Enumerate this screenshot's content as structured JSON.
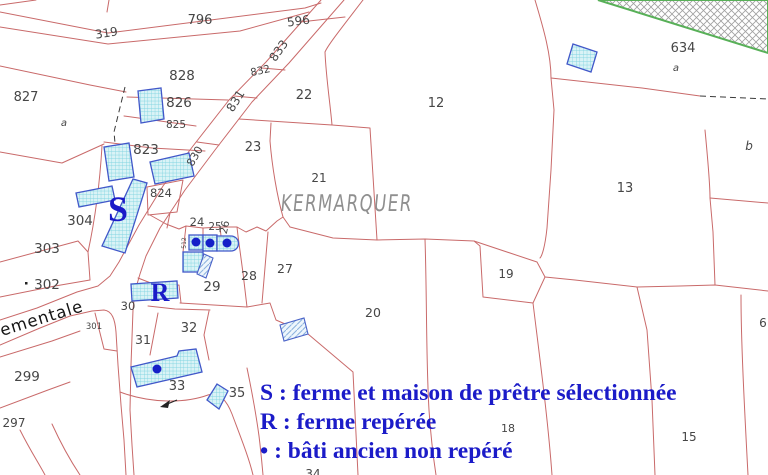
{
  "map": {
    "place_name": "KERMARQUER",
    "road_name_fragment": "ementale",
    "marker_s": {
      "text": "S",
      "x": 118,
      "y": 221,
      "size": 36
    },
    "marker_r": {
      "text": "R",
      "x": 160,
      "y": 301,
      "size": 26
    },
    "colors": {
      "parcel_line": "#c96a6a",
      "building_border": "#4157c9",
      "building_fill": "#daf3f6",
      "building_hatch": "#7ed3e0",
      "dot_blue": "#1520c8",
      "legend_blue": "#1b1bc8",
      "label_gray": "#464646",
      "place_gray": "#8f8f8f",
      "green_border": "#58b058"
    },
    "parcel_labels": [
      {
        "text": "796",
        "x": 200,
        "y": 24,
        "size": 13
      },
      {
        "text": "319",
        "x": 107,
        "y": 37,
        "size": 12,
        "rot": -9
      },
      {
        "text": "596",
        "x": 299,
        "y": 25,
        "size": 12,
        "rot": -8
      },
      {
        "text": "833",
        "x": 282,
        "y": 53,
        "size": 12,
        "rot": -55
      },
      {
        "text": "832",
        "x": 261,
        "y": 74,
        "size": 10.5,
        "rot": -12
      },
      {
        "text": "831",
        "x": 239,
        "y": 103,
        "size": 12,
        "rot": -58
      },
      {
        "text": "830",
        "x": 198,
        "y": 158,
        "size": 11,
        "rot": -60
      },
      {
        "text": "827",
        "x": 26,
        "y": 101,
        "size": 13
      },
      {
        "text": "828",
        "x": 182,
        "y": 80,
        "size": 13.5
      },
      {
        "text": "826",
        "x": 179,
        "y": 107,
        "size": 13.5
      },
      {
        "text": "825",
        "x": 176,
        "y": 128,
        "size": 10.5
      },
      {
        "text": "823",
        "x": 146,
        "y": 154,
        "size": 13.5
      },
      {
        "text": "824",
        "x": 161,
        "y": 197,
        "size": 11.5
      },
      {
        "text": "a",
        "x": 64,
        "y": 126,
        "size": 10,
        "italic": true
      },
      {
        "text": "22",
        "x": 304,
        "y": 99,
        "size": 13
      },
      {
        "text": "23",
        "x": 253,
        "y": 151,
        "size": 13
      },
      {
        "text": "21",
        "x": 319,
        "y": 182,
        "size": 12
      },
      {
        "text": "12",
        "x": 436,
        "y": 107,
        "size": 13
      },
      {
        "text": "13",
        "x": 625,
        "y": 192,
        "size": 13
      },
      {
        "text": "634",
        "x": 683,
        "y": 52,
        "size": 13
      },
      {
        "text": "a",
        "x": 676,
        "y": 71,
        "size": 10,
        "italic": true
      },
      {
        "text": "b",
        "x": 749,
        "y": 150,
        "size": 12,
        "italic": true
      },
      {
        "text": "304",
        "x": 80,
        "y": 225,
        "size": 13.5
      },
      {
        "text": "303",
        "x": 47,
        "y": 253,
        "size": 13.5
      },
      {
        "text": "302",
        "x": 47,
        "y": 289,
        "size": 13.5
      },
      {
        "text": "301",
        "x": 94,
        "y": 329,
        "size": 8.5
      },
      {
        "text": "299",
        "x": 27,
        "y": 381,
        "size": 13.5
      },
      {
        "text": "297",
        "x": 14,
        "y": 427,
        "size": 12
      },
      {
        "text": "30",
        "x": 128,
        "y": 310,
        "size": 11.5
      },
      {
        "text": "31",
        "x": 143,
        "y": 344,
        "size": 12.5
      },
      {
        "text": "32",
        "x": 189,
        "y": 332,
        "size": 13
      },
      {
        "text": "33",
        "x": 177,
        "y": 390,
        "size": 13
      },
      {
        "text": "35",
        "x": 237,
        "y": 397,
        "size": 13
      },
      {
        "text": "34",
        "x": 313,
        "y": 478,
        "size": 12
      },
      {
        "text": "29",
        "x": 212,
        "y": 291,
        "size": 13.5
      },
      {
        "text": "28",
        "x": 249,
        "y": 280,
        "size": 12.5
      },
      {
        "text": "27",
        "x": 285,
        "y": 273,
        "size": 12.5
      },
      {
        "text": "24",
        "x": 197,
        "y": 226,
        "size": 11.5
      },
      {
        "text": "25",
        "x": 215,
        "y": 230,
        "size": 10.5
      },
      {
        "text": "26",
        "x": 228,
        "y": 228,
        "size": 10.5,
        "rot": -78
      },
      {
        "text": "512",
        "x": 186,
        "y": 243,
        "size": 6,
        "rot": -90
      },
      {
        "text": "20",
        "x": 373,
        "y": 317,
        "size": 12.5
      },
      {
        "text": "19",
        "x": 506,
        "y": 278,
        "size": 12
      },
      {
        "text": "18",
        "x": 508,
        "y": 432,
        "size": 11
      },
      {
        "text": "15",
        "x": 689,
        "y": 441,
        "size": 12
      },
      {
        "text": "6",
        "x": 763,
        "y": 327,
        "size": 12
      }
    ],
    "bati_dots": [
      [
        196,
        242
      ],
      [
        210,
        243
      ],
      [
        227,
        243
      ],
      [
        157,
        369
      ]
    ],
    "legend": {
      "items": [
        "S : ferme et maison de prêtre sélectionnée",
        "R : ferme repérée",
        "• : bâti ancien non repéré"
      ]
    }
  }
}
